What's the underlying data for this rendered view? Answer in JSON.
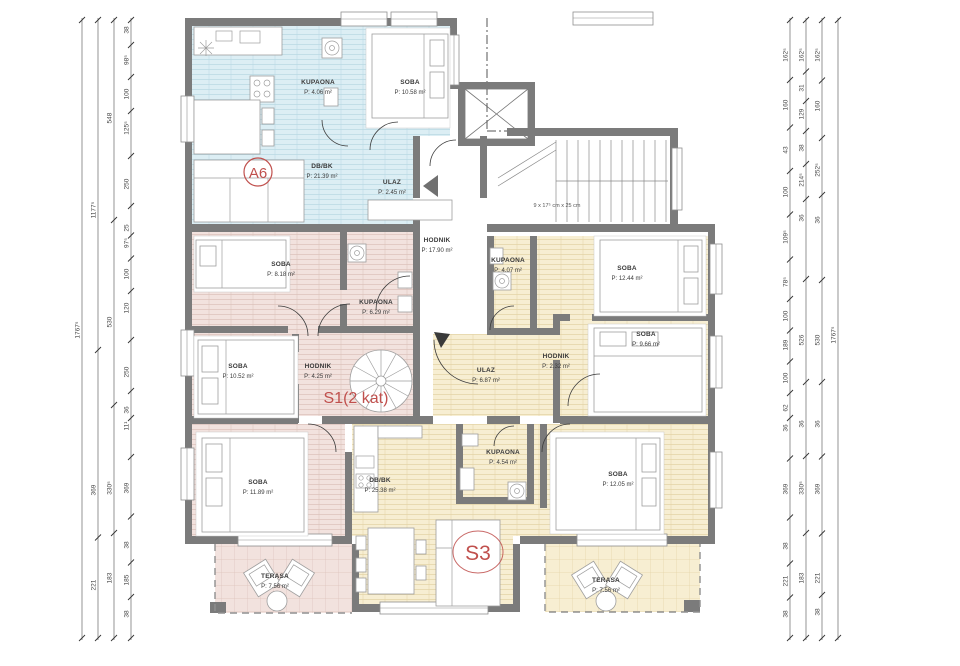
{
  "units": {
    "a6": "A6",
    "s1": "S1(2 kat)",
    "s3": "S3"
  },
  "stairs_note": "9 x 17⁵ cm x 25 cm",
  "rooms": [
    {
      "name": "KUPAONA",
      "area": "P: 4.06 m²"
    },
    {
      "name": "SOBA",
      "area": "P: 10.58 m²"
    },
    {
      "name": "DB/BK",
      "area": "P: 21.39 m²"
    },
    {
      "name": "ULAZ",
      "area": "P: 2.45 m²"
    },
    {
      "name": "HODNIK",
      "area": "P: 17.90 m²"
    },
    {
      "name": "KUPAONA",
      "area": "P: 4.07 m²"
    },
    {
      "name": "SOBA",
      "area": "P: 12.44 m²"
    },
    {
      "name": "SOBA",
      "area": "P: 8.18 m²"
    },
    {
      "name": "KUPAONA",
      "area": "P: 6.29 m²"
    },
    {
      "name": "SOBA",
      "area": "P: 10.52 m²"
    },
    {
      "name": "HODNIK",
      "area": "P: 4.25 m²"
    },
    {
      "name": "SOBA",
      "area": "P: 9.66 m²"
    },
    {
      "name": "HODNIK",
      "area": "P: 2.32 m²"
    },
    {
      "name": "ULAZ",
      "area": "P: 6.87 m²"
    },
    {
      "name": "SOBA",
      "area": "P: 11.89 m²"
    },
    {
      "name": "DB/BK",
      "area": "P: 25.38 m²"
    },
    {
      "name": "KUPAONA",
      "area": "P: 4.54 m²"
    },
    {
      "name": "SOBA",
      "area": "P: 12.05 m²"
    },
    {
      "name": "TERASA",
      "area": "P: 7.56 m²"
    },
    {
      "name": "TERASA",
      "area": "P: 7.56 m²"
    }
  ],
  "dims": {
    "left": [
      {
        "x": 82,
        "labels": [
          {
            "v": "1767⁵",
            "y": 330
          }
        ]
      },
      {
        "x": 98,
        "labels": [
          {
            "v": "1177⁵",
            "y": 210
          },
          {
            "v": "369",
            "y": 490
          },
          {
            "v": "221",
            "y": 585
          }
        ]
      },
      {
        "x": 114,
        "labels": [
          {
            "v": "548",
            "y": 118
          },
          {
            "v": "530",
            "y": 322
          },
          {
            "v": "330⁵",
            "y": 488
          },
          {
            "v": "183",
            "y": 578
          }
        ]
      },
      {
        "x": 131,
        "labels": [
          {
            "v": "38",
            "y": 30
          },
          {
            "v": "98⁵",
            "y": 60
          },
          {
            "v": "100",
            "y": 94
          },
          {
            "v": "125⁵",
            "y": 128
          },
          {
            "v": "250",
            "y": 184
          },
          {
            "v": "25",
            "y": 228
          },
          {
            "v": "97⁵",
            "y": 243
          },
          {
            "v": "100",
            "y": 274
          },
          {
            "v": "120",
            "y": 308
          },
          {
            "v": "250",
            "y": 372
          },
          {
            "v": "36",
            "y": 410
          },
          {
            "v": "11¹",
            "y": 426
          },
          {
            "v": "369",
            "y": 488
          },
          {
            "v": "38",
            "y": 545
          },
          {
            "v": "185",
            "y": 580
          },
          {
            "v": "38",
            "y": 614
          }
        ]
      }
    ],
    "right": [
      {
        "x": 790,
        "labels": [
          {
            "v": "162⁵",
            "y": 55
          },
          {
            "v": "160",
            "y": 105
          },
          {
            "v": "43",
            "y": 150
          },
          {
            "v": "100",
            "y": 192
          },
          {
            "v": "109⁵",
            "y": 237
          },
          {
            "v": "78⁵",
            "y": 282
          },
          {
            "v": "100",
            "y": 316
          },
          {
            "v": "189",
            "y": 345
          },
          {
            "v": "100",
            "y": 378
          },
          {
            "v": "62",
            "y": 408
          },
          {
            "v": "36",
            "y": 428
          },
          {
            "v": "369",
            "y": 489
          },
          {
            "v": "38",
            "y": 546
          },
          {
            "v": "221",
            "y": 581
          },
          {
            "v": "38",
            "y": 614
          }
        ]
      },
      {
        "x": 806,
        "labels": [
          {
            "v": "162⁵",
            "y": 55
          },
          {
            "v": "31",
            "y": 88
          },
          {
            "v": "129",
            "y": 114
          },
          {
            "v": "38",
            "y": 148
          },
          {
            "v": "214⁵",
            "y": 180
          },
          {
            "v": "36",
            "y": 218
          },
          {
            "v": "526",
            "y": 340
          },
          {
            "v": "36",
            "y": 424
          },
          {
            "v": "330⁵",
            "y": 488
          },
          {
            "v": "183",
            "y": 578
          }
        ]
      },
      {
        "x": 822,
        "labels": [
          {
            "v": "162⁵",
            "y": 55
          },
          {
            "v": "160",
            "y": 106
          },
          {
            "v": "252⁵",
            "y": 170
          },
          {
            "v": "36",
            "y": 220
          },
          {
            "v": "530",
            "y": 340
          },
          {
            "v": "36",
            "y": 424
          },
          {
            "v": "369",
            "y": 489
          },
          {
            "v": "221",
            "y": 578
          },
          {
            "v": "38",
            "y": 612
          }
        ]
      },
      {
        "x": 838,
        "labels": [
          {
            "v": "1767⁵",
            "y": 335
          }
        ]
      }
    ]
  },
  "colors": {
    "accent_red": "#c0504d",
    "wall_gray": "#7b7b7b",
    "apartment_blue": "#dceef4",
    "apartment_pink": "#f2e2de",
    "apartment_yellow": "#f7eed2"
  }
}
